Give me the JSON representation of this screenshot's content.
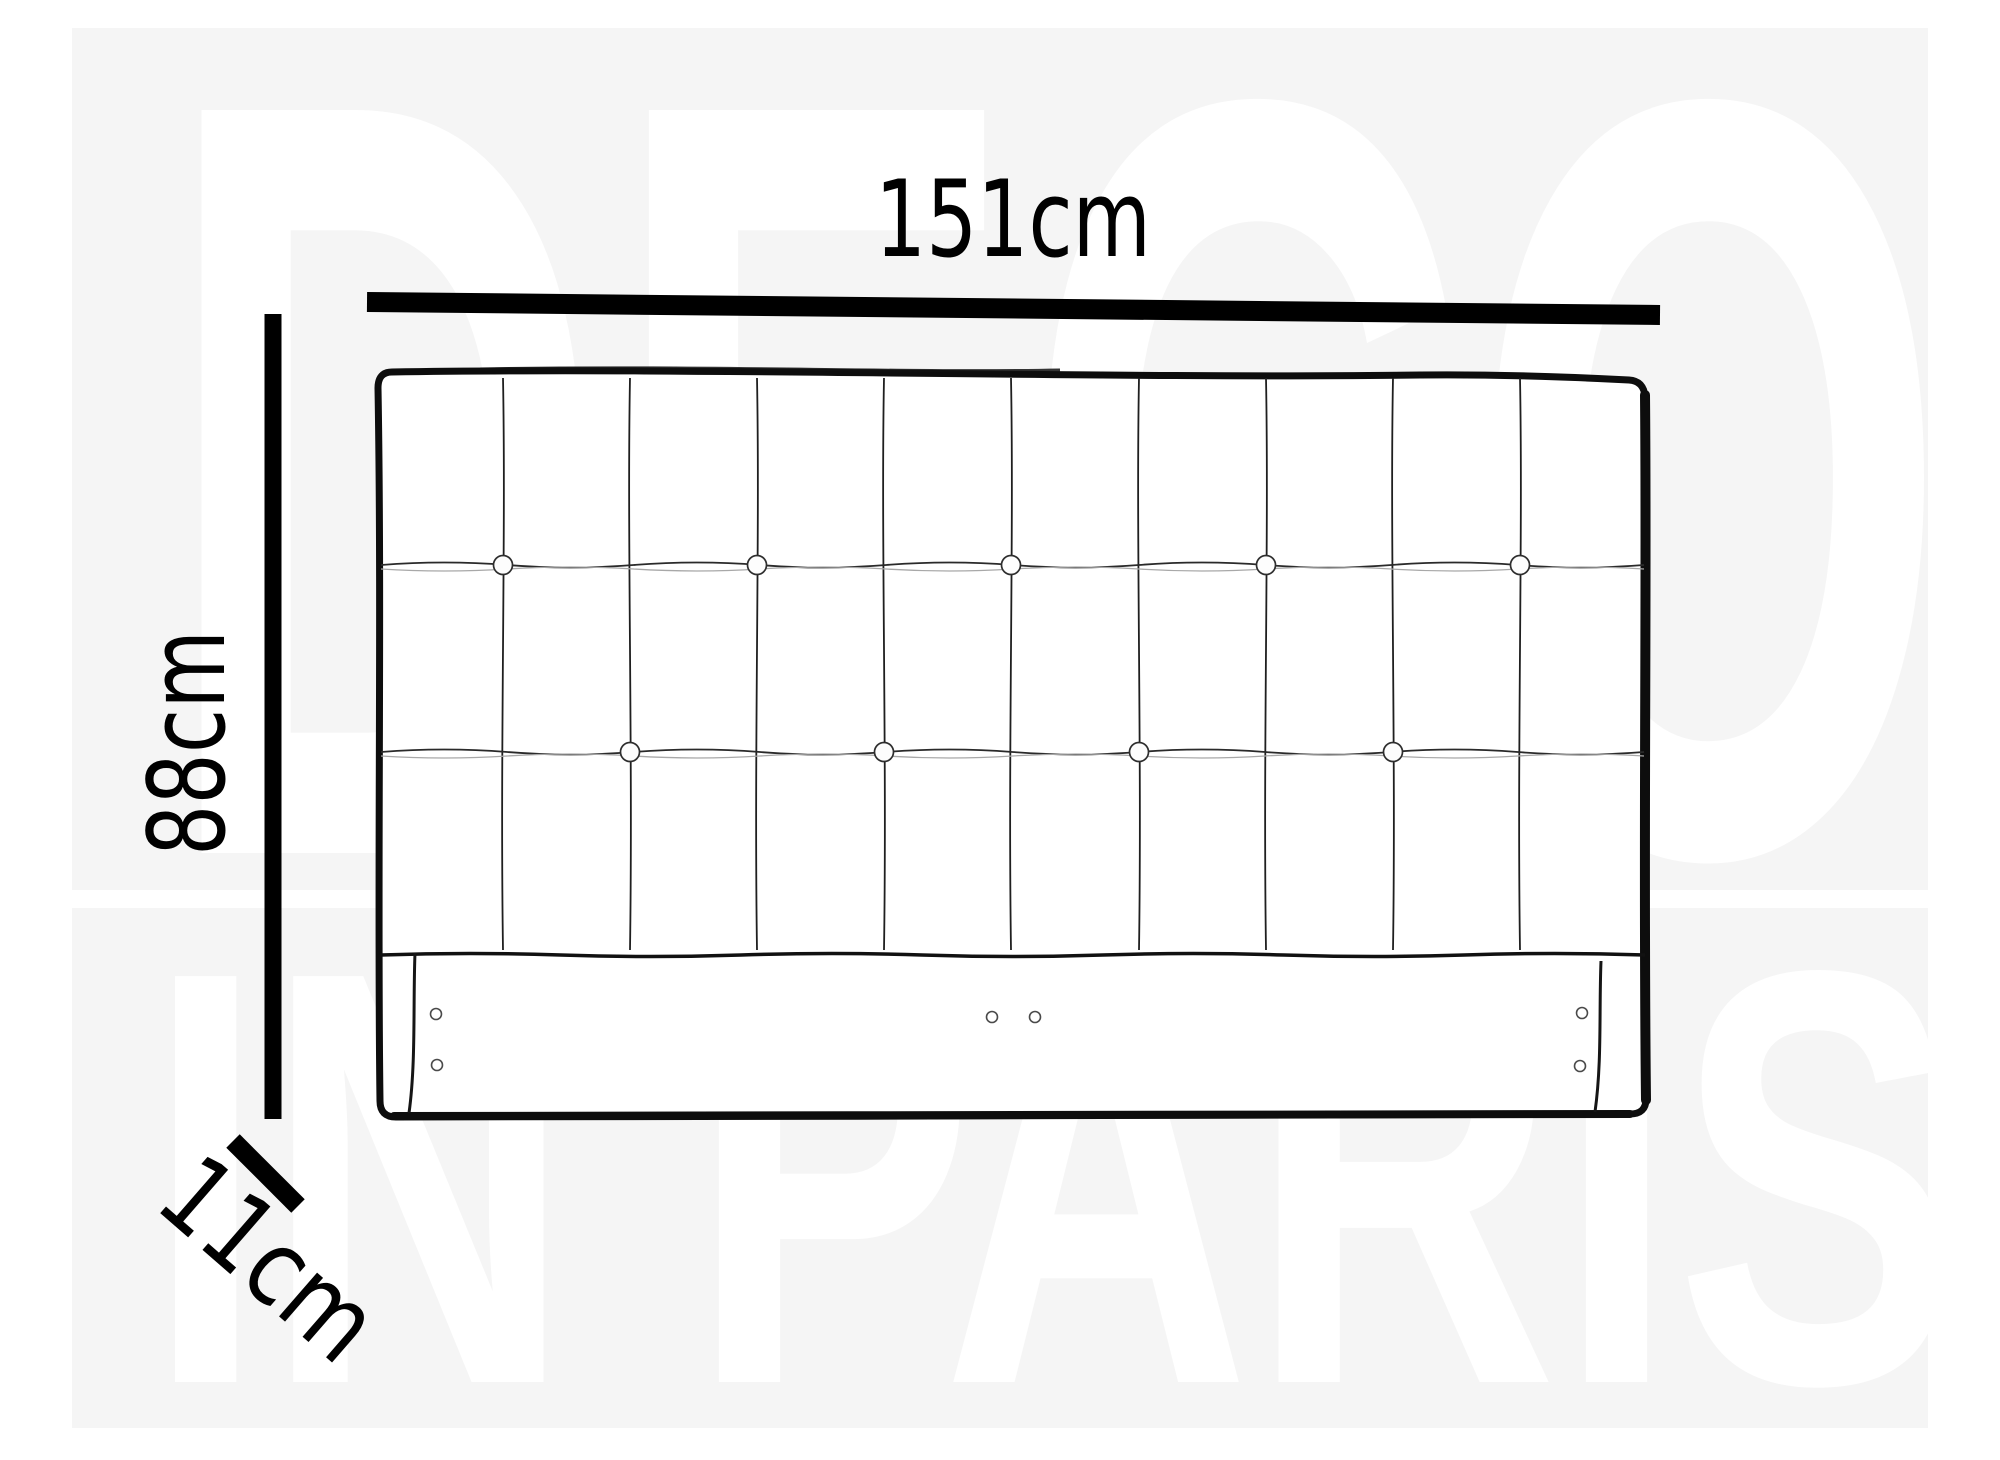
{
  "watermark": {
    "line1": "DECO",
    "line2": "IN PARIS",
    "band_color": "#f5f5f5",
    "letter_color": "#ffffff"
  },
  "dimensions": {
    "width_label": "151cm",
    "height_label": "88cm",
    "depth_label": "11cm"
  },
  "colors": {
    "ink": "#000000",
    "outline": "#0d0d0d",
    "seam": "#1f1f1f",
    "crease_dark": "#2a2a2a",
    "crease_light": "#a8a8a8",
    "button_stroke": "#2e2e2e",
    "screw_stroke": "#4a4a4a",
    "panel_fill": "#ffffff"
  },
  "diagram": {
    "type": "headboard-front-view",
    "seam_top": 378,
    "seam_bottom": 950,
    "vertical_seams": [
      503,
      630,
      757,
      884,
      1011,
      1139,
      1266,
      1393,
      1520
    ],
    "tuft_rows": [
      {
        "y": 565,
        "buttons": [
          503,
          757,
          1011,
          1266,
          1520
        ]
      },
      {
        "y": 752,
        "buttons": [
          630,
          884,
          1139,
          1393
        ]
      }
    ],
    "rail_line_y": 955,
    "rail_seams": [
      {
        "x": 415,
        "y1": 953,
        "y2": 1113
      },
      {
        "x": 1601,
        "y1": 961,
        "y2": 1112
      }
    ],
    "screws": [
      {
        "x": 436,
        "y": 1014
      },
      {
        "x": 437,
        "y": 1065
      },
      {
        "x": 992,
        "y": 1017
      },
      {
        "x": 1035,
        "y": 1017
      },
      {
        "x": 1582,
        "y": 1013
      },
      {
        "x": 1580,
        "y": 1066
      }
    ]
  }
}
